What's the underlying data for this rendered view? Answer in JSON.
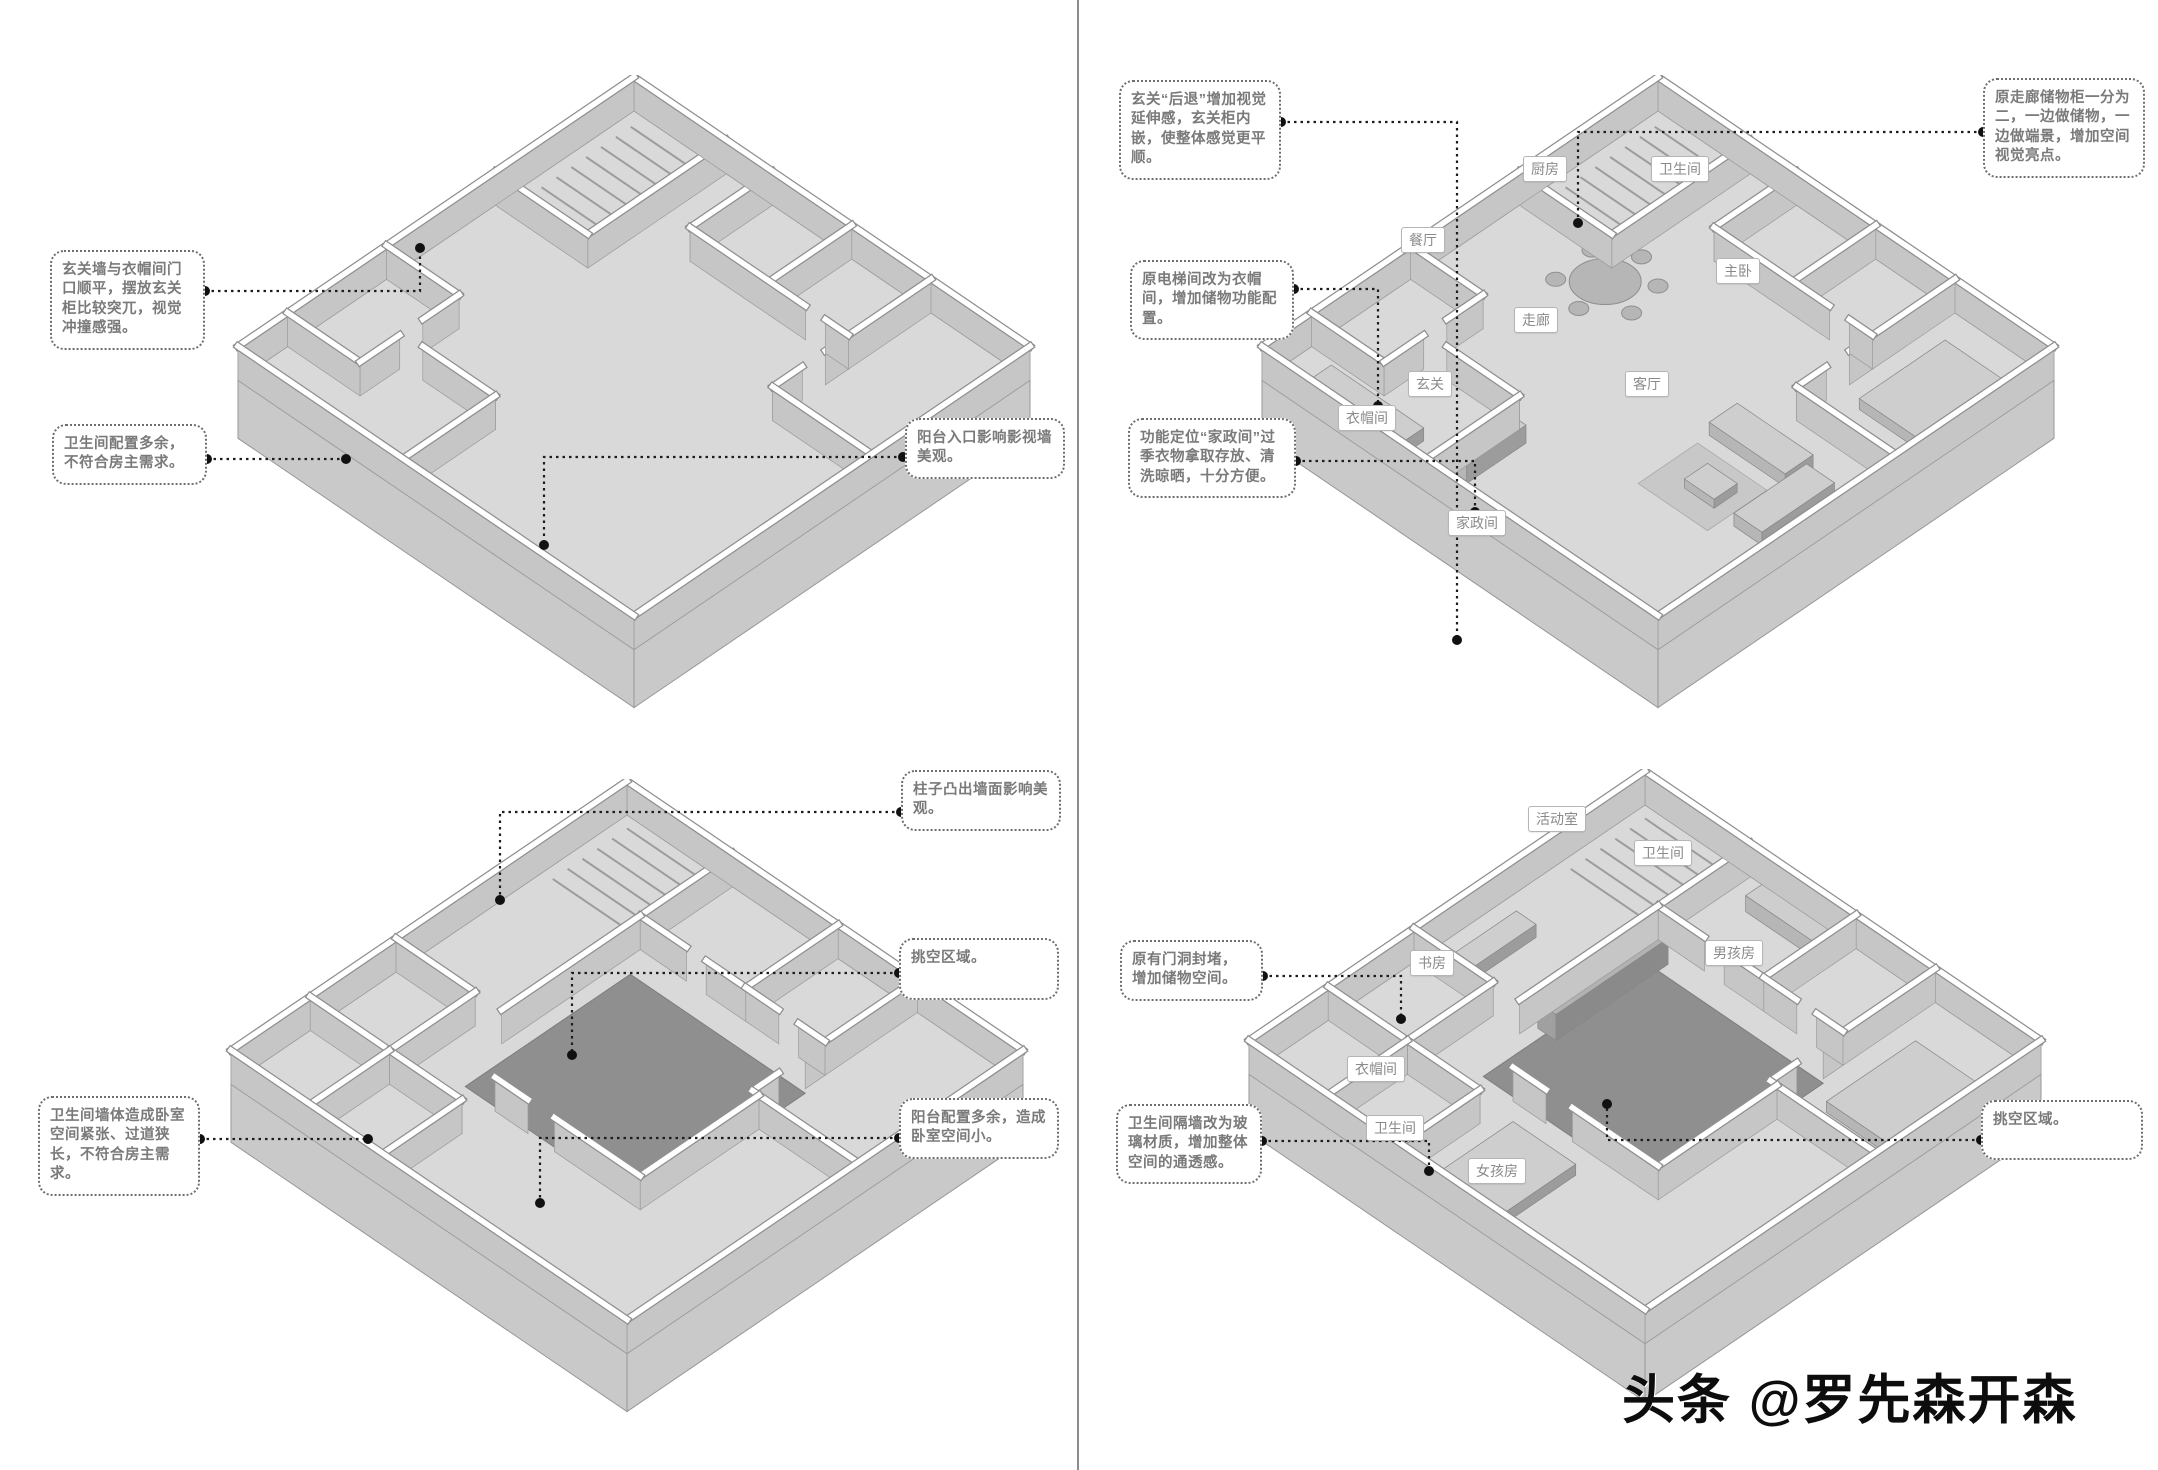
{
  "watermark": "头条 @罗先森开森",
  "before_f1": {
    "notes": {
      "entry_clash": "玄关墙与衣帽间门口顺平，摆放玄关柜比较突兀，视觉冲撞感强。",
      "bath_extra": "卫生间配置多余，不符合房主需求。",
      "balcony_tv": "阳台入口影响影视墙美观。"
    }
  },
  "before_f2": {
    "notes": {
      "column": "柱子凸出墙面影响美观。",
      "void_area": "挑空区域。",
      "balcony_extra": "阳台配置多余，造成卧室空间小。",
      "bath_wall": "卫生间墙体造成卧室空间紧张、过道狭长，不符合房主需求。"
    }
  },
  "after_f1": {
    "notes": {
      "entry_recess": "玄关“后退”增加视觉延伸感，玄关柜内嵌，使整体感觉更平顺。",
      "corridor_cabinet": "原走廊储物柜一分为二，一边做储物，一边做端景，增加空间视觉亮点。",
      "elevator_cloak": "原电梯间改为衣帽间，增加储物功能配置。",
      "laundry_room": "功能定位“家政间”过季衣物拿取存放、清洗晾晒，十分方便。"
    },
    "rooms": {
      "kitchen": "厨房",
      "bath": "卫生间",
      "dining": "餐厅",
      "master": "主卧",
      "corridor": "走廊",
      "entry": "玄关",
      "cloak": "衣帽间",
      "living": "客厅",
      "laundry": "家政间"
    }
  },
  "after_f2": {
    "notes": {
      "door_sealed": "原有门洞封堵，增加储物空间。",
      "bath_glass": "卫生间隔墙改为玻璃材质，增加整体空间的通透感。",
      "void_area": "挑空区域。"
    },
    "rooms": {
      "activity": "活动室",
      "bath_upper": "卫生间",
      "study": "书房",
      "boy": "男孩房",
      "cloak": "衣帽间",
      "bath_lower": "卫生间",
      "girl": "女孩房"
    }
  }
}
